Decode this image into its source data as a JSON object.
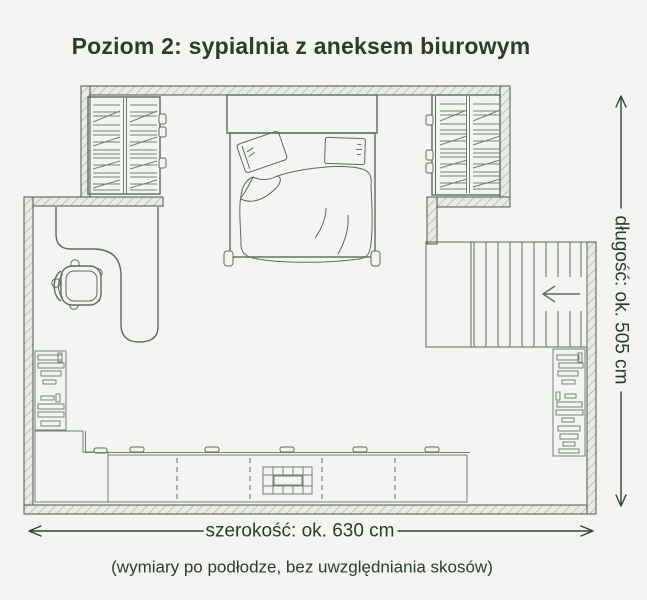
{
  "title": "Poziom 2: sypialnia z aneksem biurowym",
  "dimensions": {
    "length_label": "długość: ok. 505 cm",
    "width_label": "szerokość: ok. 630 cm",
    "footnote": "(wymiary po podłodze, bez uwzględniania skosów)"
  },
  "colors": {
    "background": "#f4f5f2",
    "wall_fill": "#e9eae6",
    "wall_hatch": "#9ba49c",
    "wall_outline": "#4a564c",
    "furniture_line": "#5b6b5f",
    "detail_green": "#6e8475",
    "text": "#2a3d2f"
  },
  "icons": {
    "stairs_direction_arrow": "←",
    "length_dimension_arrow": "↕",
    "width_dimension_arrow": "↔"
  }
}
